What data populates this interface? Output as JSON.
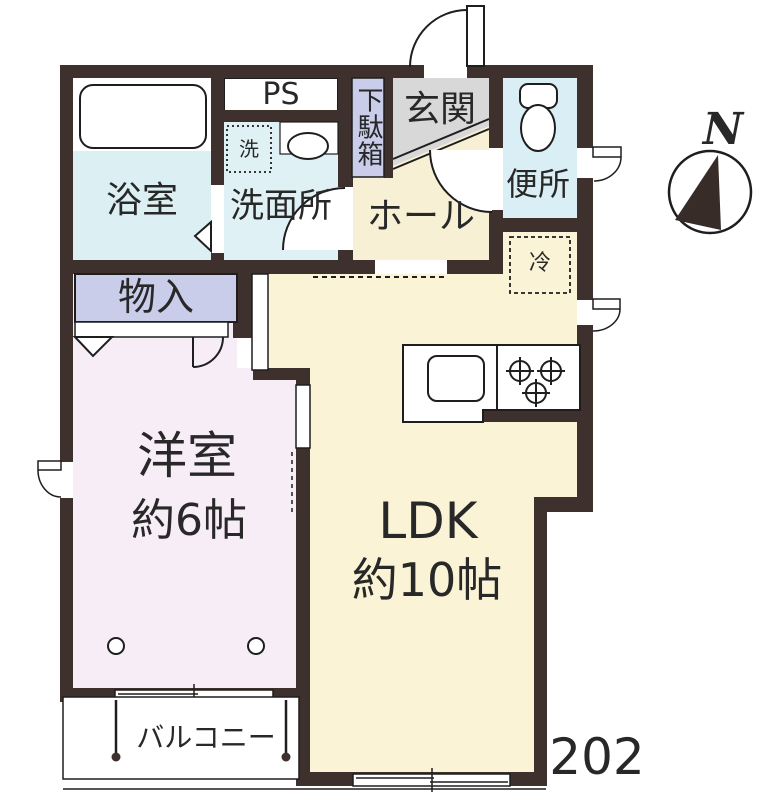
{
  "unit_number": "202",
  "compass_label": "N",
  "rooms": {
    "bath": "浴室",
    "washroom": "洗面所",
    "pipe_space": "PS",
    "shoe_cabinet": "下駄箱",
    "entrance": "玄関",
    "toilet": "便所",
    "hall": "ホール",
    "refrigerator_space": "冷",
    "washer_space": "洗",
    "storage": "物入",
    "western_room": "洋室",
    "western_room_size": "約6帖",
    "ldk": "LDK",
    "ldk_size": "約10帖",
    "balcony": "バルコニー"
  },
  "colors": {
    "wall": "#3e302c",
    "wet_rooms": "#dcf0f4",
    "ldk_floor": "#faf3d6",
    "western_room_floor": "#f7edf7",
    "storage_fill": "#c9cde9",
    "entrance_floor": "#d8d8d8",
    "line": "#1e1e1e"
  }
}
